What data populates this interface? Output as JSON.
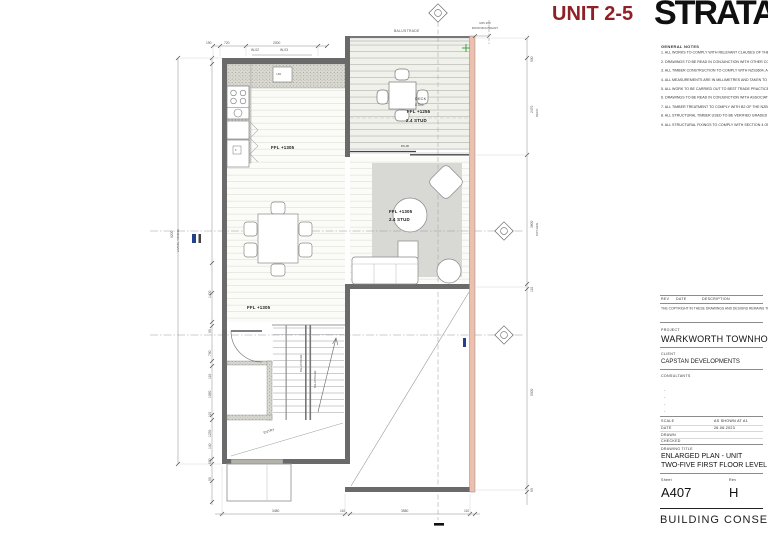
{
  "header": {
    "unit_title": "UNIT 2-5",
    "logo": "STRATA"
  },
  "stamp": "BUILDING CONSENT",
  "general_notes": {
    "title": "GENERAL NOTES",
    "items": [
      "1. ALL WORKS TO COMPLY WITH RELEVANT CLAUSES OF THE NZBC INCLUDING BUT NOT LIMITED TO E1/AS1, E2/AS1 AND C/AS1 PROVISIONS.",
      "2. DRAWINGS TO BE READ IN CONJUNCTION WITH OTHER CONSULTANTS DOCUMENTATION INCLUDING STRUCTURAL ENGINEER'S DOCUMENTATION (S.E.). ANY DISCREPANCIES ARE TO BE BROUGHT TO THE ATTENTION OF THE ARCHITECT.",
      "3. ALL TIMBER CONSTRUCTION TO COMPLY WITH NZS3604, ALTHOUGH THIS PROJECT IS SED, THE PRINCIPLES OF NZS 3604 ARE TO BE FOLLOWED WHERE APPLICABLE.",
      "4. ALL MEASUREMENTS ARE IN MILLIMETRES AND TAKEN TO STRUCTURE UNLESS NOTED OTHERWISE. ALL DIMENSIONS AND LEVELS MUST BE CHECKED ON SITE BEFORE COMMENCEMENT OF ANY WORK OR THE PREPARATION OF SHOP DRAWINGS. ADVISE ARCHITECT OF ANY DISCREPANCIES FOR INTERPRETATION. DO NOT SCALE DRAWINGS - USE FIGURED DIMENSIONS ONLY.",
      "5. ALL WORK TO BE CARRIED OUT TO BEST TRADE PRACTICE WITH ALL MATERIALS USED BEING THE BEST OF THEIR RESPECTIVE KINDS.",
      "6. DRAWINGS TO BE READ IN CONJUNCTION WITH ASSOCIATED SPECIFICATIONS, CONDITIONS OF CONTRACT, RESOURCE CONSENT DOCUMENTATION AND BUILDING CONSENT DOCUMENTATION INCLUDING ANY SPECIFIC COUNCIL CONDITIONS. ADVISE ARCHITECT OF ANY DISCREPANCIES FOR RESOLUTION.",
      "7. ALL TIMBER TREATMENT TO COMPLY WITH B2 OF THE NZBC, SECTION 4 OF NZS 3604. REFER TO SPECIFICATION AND TIMBER FRAMING.",
      "8. ALL STRUCTURAL TIMBER USED TO BE VERIFIED GRADED - STRESS GRADED TO COMPLY WITH THE CURRENT EDITION NZS 3603 AND MARKED ACCORDINGLY TO COMPLY WITH THE CURRENT EDITION NZS 3622.",
      "9. ALL STRUCTURAL FIXINGS TO COMPLY WITH SECTION 4 OF NZS 3604 (SG8) AND SED."
    ]
  },
  "revision_table": {
    "rev": "REV",
    "date": "DATE",
    "description": "DESCRIPTION",
    "copyright": "THE COPYRIGHT IN THESE DRAWINGS AND DESIGNS REMAINS THE PROPERTY OF THE ARCHITECT. VERIFY ALL DIMENSIONS ON SITE BEFORE COMMENCING ANY WORK. USE FIGURED DIMENSIONS AND LARGER SCALED DRAWINGS IN PREFERENCE TO SCALING. DISCREPANCIES TO BE REPORTED TO THE ARCHITECT BEFORE IMPLEMENTING THE WORK."
  },
  "title_block": {
    "project_label": "PROJECT",
    "project": "WARKWORTH TOWNHOUSES",
    "client_label": "CLIENT",
    "client": "CAPSTAN DEVELOPMENTS",
    "consultants_label": "CONSULTANTS",
    "consultant_rows": [
      "-",
      "-",
      "-",
      "-"
    ],
    "scale_label": "SCALE",
    "scale_value": "AS SHOWN AT A1",
    "date_label": "DATE",
    "date_value": "26.06.2023",
    "drawn_label": "DRAWN",
    "checked_label": "CHECKED",
    "drawing_title_label": "DRAWING TITLE",
    "drawing_title_1": "ENLARGED PLAN - UNIT",
    "drawing_title_2": "TWO-FIVE FIRST FLOOR LEVEL",
    "sheet_label": "Sheet",
    "sheet_value": "A407",
    "rev_label": "Rev",
    "rev_value": "H"
  },
  "plan": {
    "labels": {
      "balustrade": "BALUSTRADE",
      "min_boundary_1": "MIN 300",
      "min_boundary_2": "FROM BOUNDARY",
      "deck_name": "DECK",
      "deck_area": "8.5m²",
      "deck_ffl": "FFL +1255",
      "deck_stud": "2.4 STUD",
      "living_ffl": "FFL +1305",
      "living_stud": "2.4 STUD",
      "kitchen_ffl": "FFL +1305",
      "dining_ffl": "FFL +1305",
      "entry": "ENTRY",
      "window_tag_1": "W-02",
      "window_tag_2": "W-03",
      "door_tag": "DS-06",
      "hw": "HW",
      "fridge": "F",
      "stair_balustrade": "BALUSTRADE"
    },
    "dims": {
      "top": [
        "190",
        "720",
        "2000"
      ],
      "bottom": [
        "3480",
        "110",
        "3580",
        "110"
      ],
      "left_inner": [
        "1400",
        "90",
        "790",
        "110",
        "1090",
        "110",
        "1230",
        "140",
        "890",
        "90"
      ],
      "left_outer_value": "9200",
      "left_outer_room": "LIVING / DINING",
      "right_values": [
        "900",
        "2470",
        "3600",
        "110",
        "5300",
        "90"
      ],
      "right_room_1": "DECK",
      "right_room_2": "KITCHEN"
    },
    "colors": {
      "accent_red": "#8e2127",
      "party_wall": "#ecbfae",
      "tag_blue": "#23408f",
      "marker_green": "#3fa23f"
    }
  }
}
